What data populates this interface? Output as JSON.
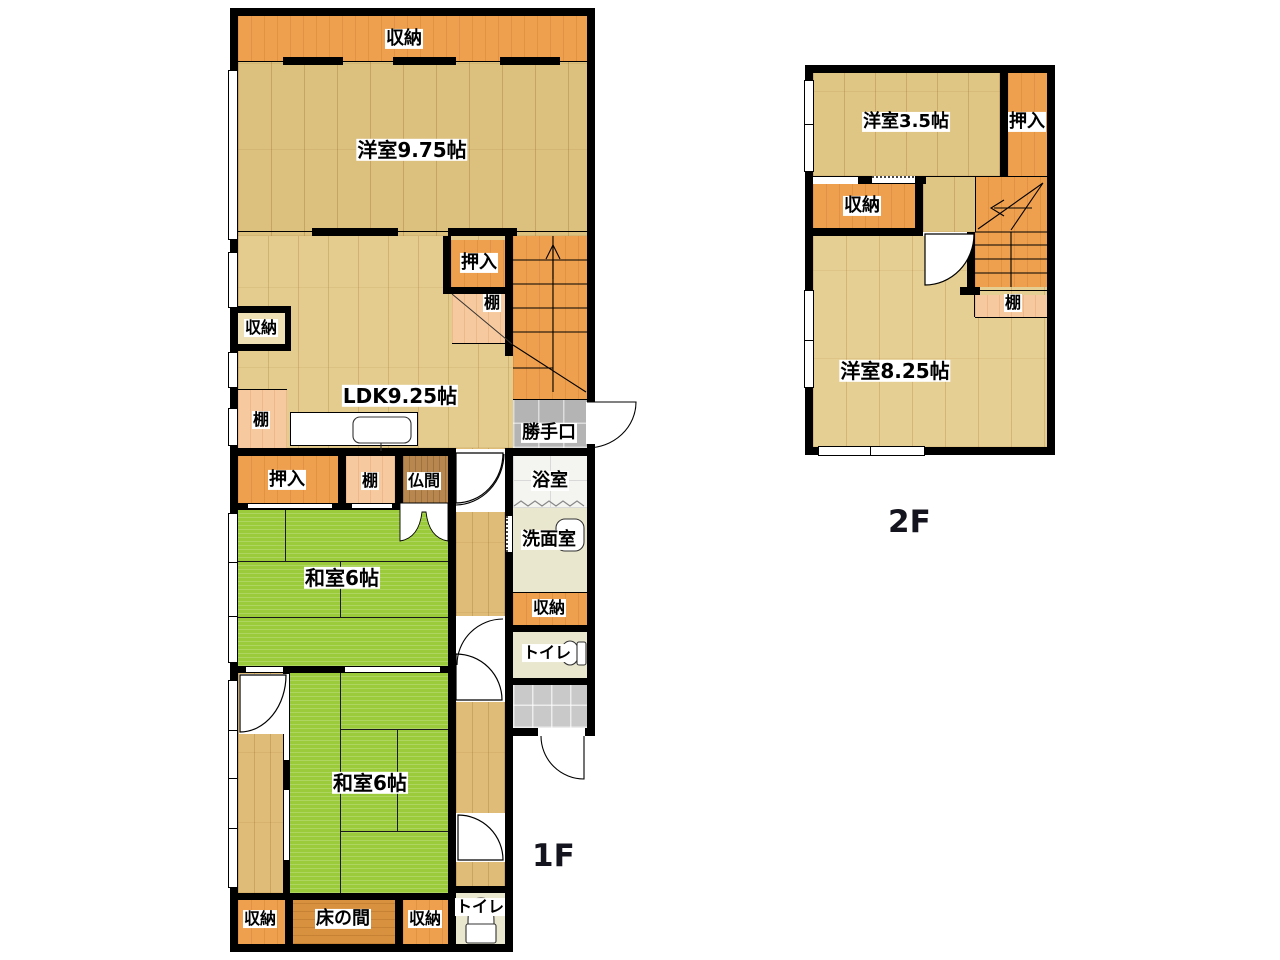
{
  "floor1": {
    "title": "1F",
    "rooms": {
      "closet_top": "収納",
      "western_975": "洋室9.75帖",
      "oshiire_ldk": "押入",
      "tana_stairs": "棚",
      "closet_niche": "収納",
      "ldk": "LDK9.25帖",
      "tana_kitchen": "棚",
      "katteguchi": "勝手口",
      "oshiire": "押入",
      "tana": "棚",
      "butsuma": "仏間",
      "bath": "浴室",
      "washroom": "洗面室",
      "closet_hall": "収納",
      "toilet_hall": "トイレ",
      "washitsu_upper": "和室6帖",
      "washitsu_lower": "和室6帖",
      "closet_bottom_left": "収納",
      "tokonoma": "床の間",
      "closet_bottom_center": "収納",
      "toilet_bottom": "トイレ"
    }
  },
  "floor2": {
    "title": "2F",
    "rooms": {
      "western_35": "洋室3.5帖",
      "oshiire": "押入",
      "closet": "収納",
      "tana": "棚",
      "western_825": "洋室8.25帖"
    }
  },
  "colors": {
    "wall": "#000000",
    "wood_light": "#dcc07e",
    "wood_ldk": "#e3cc8e",
    "wood_corridor": "#dfbc77",
    "wood_2f": "#e6cf92",
    "tatami_green": "#9bcb3a",
    "storage_orange": "#efa04e",
    "shelf_peach": "#f6c99e",
    "tokonoma_wood": "#d8913f",
    "butsuma_wood": "#b7874f",
    "entry_tile_gray": "#c9c9c9",
    "backdoor_tile_gray": "#b4b4b4",
    "bath_white": "#f4f4f1",
    "sanitary_beige": "#eae7cf"
  }
}
